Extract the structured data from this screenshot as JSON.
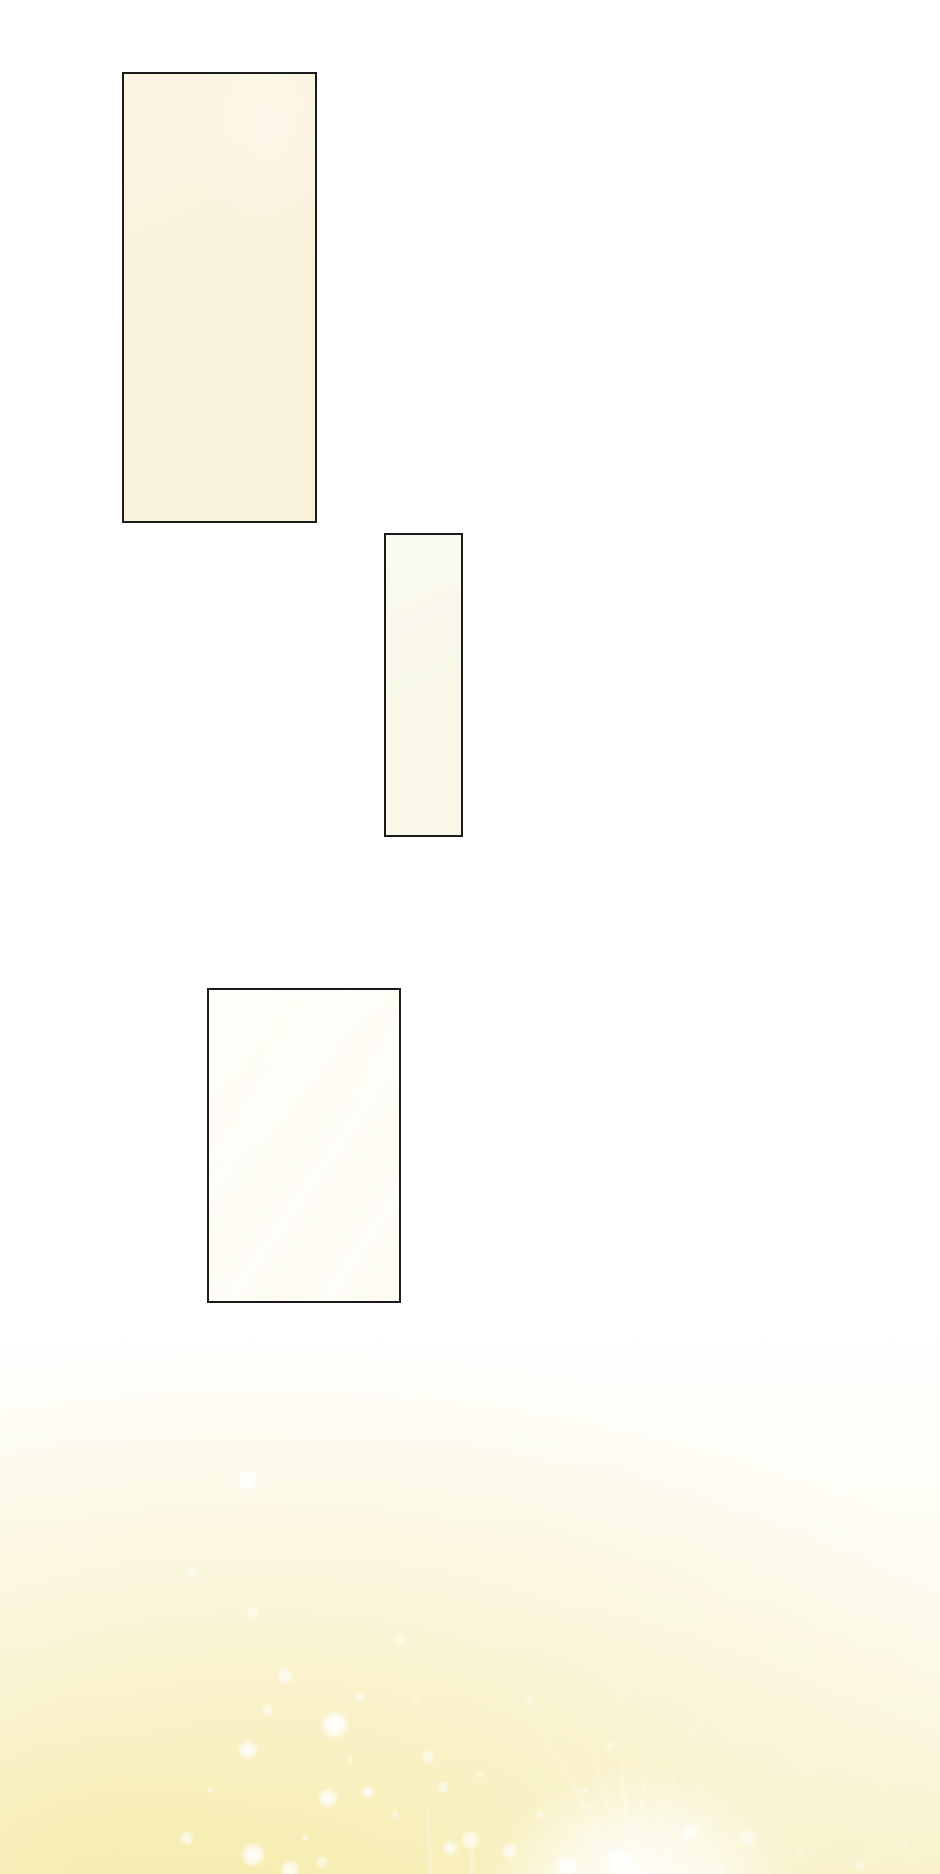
{
  "page": {
    "background": "#ffffff",
    "width": 940,
    "height": 1874
  },
  "panels": [
    {
      "name": "panel-1",
      "fill": "#faf1da",
      "fill_light": "#fcf5e3",
      "border": "#1b1b1b"
    },
    {
      "name": "panel-2",
      "fill": "#f8f7e8",
      "fill_light": "#fbfaf0",
      "border": "#1b1b1b"
    },
    {
      "name": "panel-3",
      "fill": "#fdfbf1",
      "fill_light": "#fffef8",
      "border": "#1b1b1b"
    }
  ],
  "effects": {
    "glow_color": "#f6eeb6",
    "glow_soft": "#faf4d4",
    "flare_color": "#ffffff",
    "sparkles": [
      {
        "x": 248,
        "y": 1480,
        "r": 12,
        "o": 0.95
      },
      {
        "x": 192,
        "y": 1572,
        "r": 6,
        "o": 0.5
      },
      {
        "x": 253,
        "y": 1612,
        "r": 7,
        "o": 0.55
      },
      {
        "x": 285,
        "y": 1676,
        "r": 9,
        "o": 0.7
      },
      {
        "x": 335,
        "y": 1725,
        "r": 15,
        "o": 1.0
      },
      {
        "x": 248,
        "y": 1750,
        "r": 11,
        "o": 0.9
      },
      {
        "x": 267,
        "y": 1710,
        "r": 7,
        "o": 0.6
      },
      {
        "x": 360,
        "y": 1697,
        "r": 6,
        "o": 0.5
      },
      {
        "x": 400,
        "y": 1640,
        "r": 6,
        "o": 0.45
      },
      {
        "x": 328,
        "y": 1798,
        "r": 11,
        "o": 0.85
      },
      {
        "x": 368,
        "y": 1792,
        "r": 8,
        "o": 0.7
      },
      {
        "x": 428,
        "y": 1757,
        "r": 8,
        "o": 0.6
      },
      {
        "x": 443,
        "y": 1787,
        "r": 7,
        "o": 0.55
      },
      {
        "x": 187,
        "y": 1838,
        "r": 8,
        "o": 0.7
      },
      {
        "x": 253,
        "y": 1855,
        "r": 13,
        "o": 0.95
      },
      {
        "x": 290,
        "y": 1870,
        "r": 11,
        "o": 0.85
      },
      {
        "x": 322,
        "y": 1862,
        "r": 7,
        "o": 0.6
      },
      {
        "x": 450,
        "y": 1848,
        "r": 9,
        "o": 0.75
      },
      {
        "x": 470,
        "y": 1840,
        "r": 10,
        "o": 0.8
      },
      {
        "x": 510,
        "y": 1851,
        "r": 9,
        "o": 0.75
      },
      {
        "x": 567,
        "y": 1866,
        "r": 13,
        "o": 0.95
      },
      {
        "x": 620,
        "y": 1862,
        "r": 16,
        "o": 1.0
      },
      {
        "x": 690,
        "y": 1832,
        "r": 10,
        "o": 0.8
      },
      {
        "x": 747,
        "y": 1838,
        "r": 9,
        "o": 0.7
      },
      {
        "x": 530,
        "y": 1700,
        "r": 6,
        "o": 0.4
      },
      {
        "x": 610,
        "y": 1745,
        "r": 6,
        "o": 0.4
      },
      {
        "x": 210,
        "y": 1790,
        "r": 4,
        "o": 0.5
      },
      {
        "x": 305,
        "y": 1838,
        "r": 4,
        "o": 0.6
      },
      {
        "x": 395,
        "y": 1815,
        "r": 5,
        "o": 0.5
      },
      {
        "x": 350,
        "y": 1760,
        "r": 4,
        "o": 0.5
      },
      {
        "x": 415,
        "y": 1700,
        "r": 4,
        "o": 0.4
      },
      {
        "x": 480,
        "y": 1775,
        "r": 4,
        "o": 0.45
      },
      {
        "x": 540,
        "y": 1815,
        "r": 5,
        "o": 0.5
      },
      {
        "x": 585,
        "y": 1790,
        "r": 4,
        "o": 0.45
      },
      {
        "x": 660,
        "y": 1862,
        "r": 6,
        "o": 0.6
      },
      {
        "x": 720,
        "y": 1870,
        "r": 5,
        "o": 0.5
      },
      {
        "x": 800,
        "y": 1855,
        "r": 5,
        "o": 0.4
      },
      {
        "x": 860,
        "y": 1865,
        "r": 6,
        "o": 0.45
      },
      {
        "x": 905,
        "y": 1845,
        "r": 4,
        "o": 0.35
      }
    ],
    "rays": [
      {
        "x": 630,
        "y": 1885,
        "a": -44,
        "l": 180,
        "o": 0.45
      },
      {
        "x": 630,
        "y": 1885,
        "a": -30,
        "l": 240,
        "o": 0.5
      },
      {
        "x": 630,
        "y": 1885,
        "a": -16,
        "l": 210,
        "o": 0.5
      },
      {
        "x": 630,
        "y": 1885,
        "a": -4,
        "l": 260,
        "o": 0.55
      },
      {
        "x": 630,
        "y": 1885,
        "a": 8,
        "l": 230,
        "o": 0.5
      },
      {
        "x": 630,
        "y": 1885,
        "a": 22,
        "l": 250,
        "o": 0.5
      },
      {
        "x": 630,
        "y": 1885,
        "a": 36,
        "l": 200,
        "o": 0.45
      },
      {
        "x": 630,
        "y": 1885,
        "a": 50,
        "l": 160,
        "o": 0.4
      },
      {
        "x": 430,
        "y": 1878,
        "a": -2,
        "l": 110,
        "o": 0.5
      },
      {
        "x": 470,
        "y": 1875,
        "a": 5,
        "l": 80,
        "o": 0.45
      }
    ]
  }
}
